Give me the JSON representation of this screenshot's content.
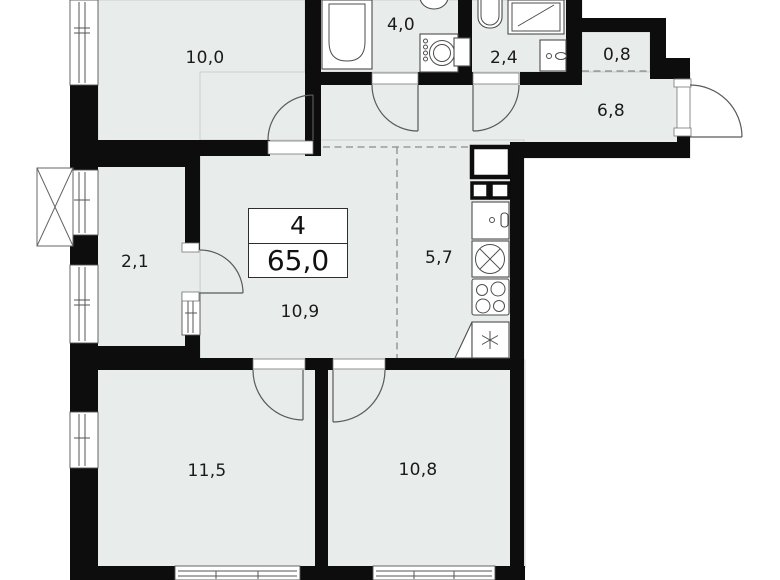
{
  "summary": {
    "rooms_count": "4",
    "total_area": "65,0"
  },
  "rooms": {
    "bedroom_top": {
      "area": "10,0"
    },
    "bathroom": {
      "area": "4,0"
    },
    "wc": {
      "area": "2,4"
    },
    "storage": {
      "area": "0,8"
    },
    "hallway": {
      "area": "6,8"
    },
    "wardrobe": {
      "area": "2,1"
    },
    "kitchen": {
      "area": "5,7"
    },
    "corridor": {
      "area": "10,9"
    },
    "bedroom_left": {
      "area": "11,5"
    },
    "bedroom_right": {
      "area": "10,8"
    }
  },
  "colors": {
    "wall": "#0d0d0d",
    "floor": "#e8ecea",
    "line": "#4d4d4d",
    "bg": "#ffffff"
  }
}
